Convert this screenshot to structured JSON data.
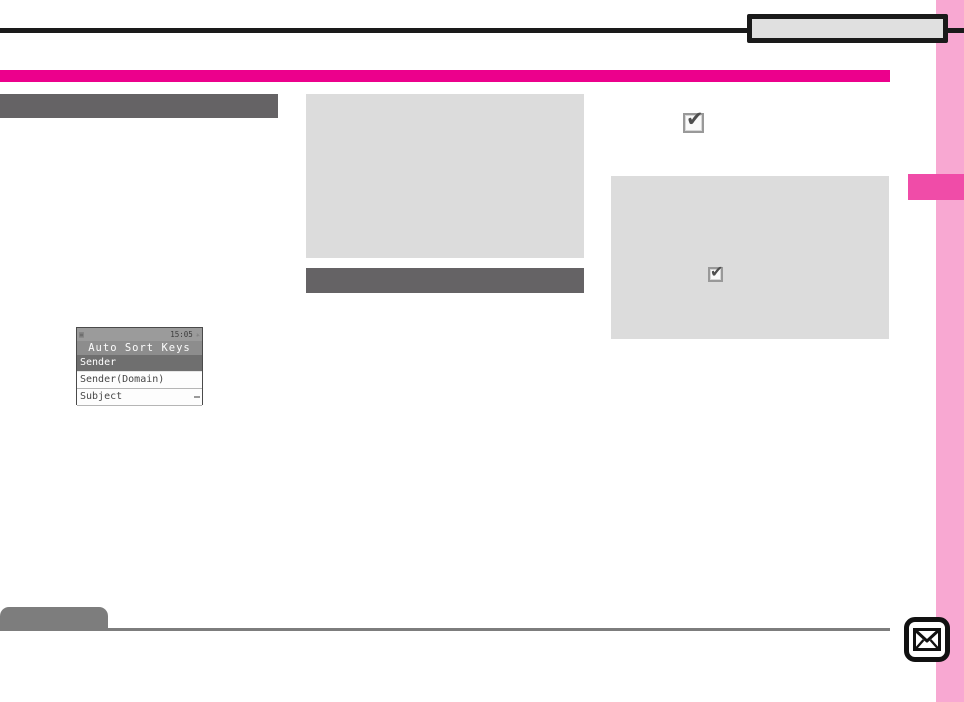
{
  "palette": {
    "magenta_accent": "#ec008c",
    "side_tab_pink": "#f04ca8",
    "margin_strip_pink": "#f8a8d2",
    "placeholder_gray": "#dcdcdc",
    "heading_bar_gray": "#656365",
    "footer_gray": "#7d7d7d",
    "rule_black": "#1a1a1a",
    "header_tab_fill": "#e0e0e0"
  },
  "icons": {
    "check_glyph": "✔",
    "status_left_glyph": "▣",
    "status_sparkle_glyph": "✳",
    "mail_icon_name": "envelope"
  },
  "phone_screen": {
    "status_time": "15:05",
    "title": "Auto Sort Keys",
    "menu_items": [
      {
        "label": "Sender",
        "selected": true
      },
      {
        "label": "Sender(Domain)",
        "selected": false
      },
      {
        "label": "Subject",
        "selected": false
      }
    ]
  }
}
